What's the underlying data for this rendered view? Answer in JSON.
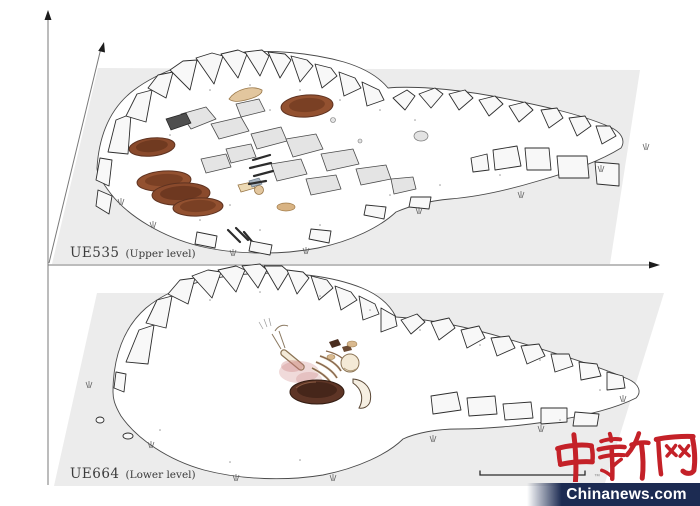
{
  "panels": {
    "upper": {
      "code": "UE535",
      "level_label": "(Upper level)"
    },
    "lower": {
      "code": "UE664",
      "level_label": "(Lower level)"
    }
  },
  "watermark": {
    "logo_cn": "中新网",
    "trademark": "™",
    "site": "Chinanews.com",
    "logo_color": "#c42128",
    "banner_color": "#1c2b52"
  },
  "palette": {
    "plane_gray": "#ececec",
    "line_ink": "#4a4a4a",
    "pottery_brown": "#935130",
    "bowl_dark_brown": "#5e3526",
    "bone_tan": "#e2c69e",
    "ochre_stain": "#c97a7a"
  }
}
